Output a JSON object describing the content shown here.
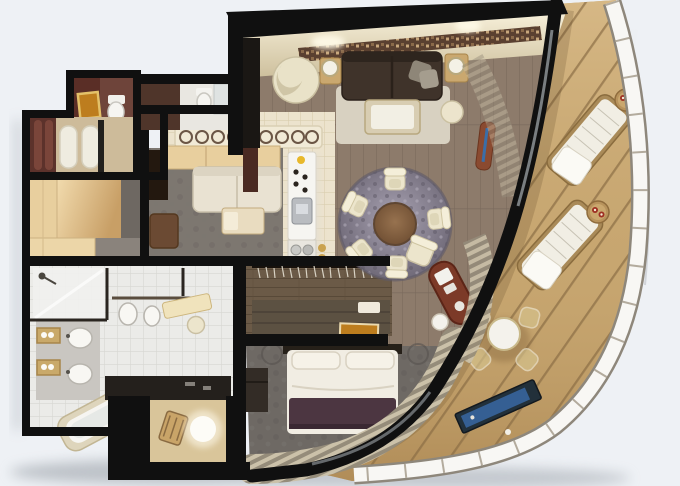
{
  "image": {
    "kind": "3d-rendered-floor-plan",
    "subject": "luxury cruise-ship suite top-down cutaway render with wrap-around balcony",
    "visible_text": ""
  },
  "colors": {
    "background": "#eef1f5",
    "wall": "#101010",
    "woodFloor": "#8d7b6b",
    "entryTile": "#ece3cd",
    "denCarpet": "#7d7770",
    "foyerCarpet": "#8a837c",
    "bedroomCarpet": "#6e6964",
    "closetWood": "#6b5a47",
    "bathroomTile": "#ebebe8",
    "marble": "#c9c6c1",
    "deck": "#c7a670",
    "deckPlank": "#8a6c44",
    "railing": "#f8f7f4",
    "glassCanopy": "#ecf0f2",
    "creamFurniture": "#ece5cc",
    "sofaDark": "#3f332a",
    "denSofa": "#e9e2d2",
    "duvet": "#f1ede3",
    "bedThrow": "#4c3641",
    "headboard": "#262019",
    "diningRug": "#8a8492",
    "diningTable": "#7d5b3d",
    "mahogany": "#7c3a28",
    "maroonWall": "#5a2e26",
    "goldArt": "#bd7d1e",
    "curtain": "#b3aa94",
    "lattice": "#f1ead6",
    "barCounter": "#f6f5f1",
    "lightWood": "#e8cf9e",
    "nicheFloor": "#d9c59a",
    "tvScreen": "#355f93",
    "lampGlow": "#fdfcf7"
  },
  "scene": {
    "rooms": [
      "living-room",
      "dining-area",
      "entry-hall",
      "wet-bar",
      "den",
      "foyer-wardrobe",
      "powder-room",
      "guest-bathroom",
      "dressing-robes",
      "master-bathroom",
      "walk-in-closet",
      "vanity-nook",
      "master-bedroom",
      "desk-area",
      "window-nook",
      "balcony"
    ],
    "furniture": [
      "dark-sofa",
      "swivel-chair",
      "coffee-table",
      "side-lamps",
      "ottoman",
      "round-dining-table",
      "five-dining-chairs",
      "shag-rug",
      "espresso-bar",
      "lattice-screen",
      "den-sofa",
      "wardrobe",
      "double-sink-vanity",
      "bathtub",
      "shower",
      "toilet",
      "bidet",
      "hanging-rod",
      "dresser",
      "double-bed",
      "plum-throw",
      "flat-tv",
      "mahogany-desk",
      "desk-chair",
      "sphere-lamp",
      "two-sun-loungers",
      "two-drink-tables",
      "balcony-dining-set",
      "curved-railing"
    ]
  }
}
